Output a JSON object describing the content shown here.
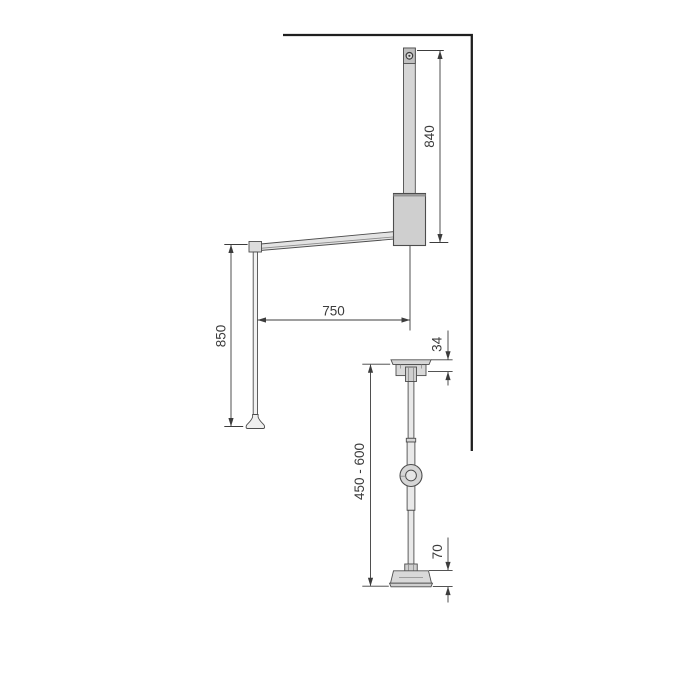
{
  "drawing": {
    "front_view": {
      "bar_height": "840",
      "arm_length": "750",
      "rod_drop": "850"
    },
    "side_view": {
      "cap_height": "34",
      "adjustable_height": "450 - 600",
      "foot_height": "70"
    },
    "colors": {
      "background": "#ffffff",
      "part_fill": "#d6d6d6",
      "part_fill_dark": "#c0c0c0",
      "part_fill_light": "#ebebeb",
      "part_outline": "#4d4d4d",
      "dimension_line": "#3c3c3c",
      "wall_line": "#1f1f1f",
      "label_text": "#3c3c3c"
    }
  }
}
